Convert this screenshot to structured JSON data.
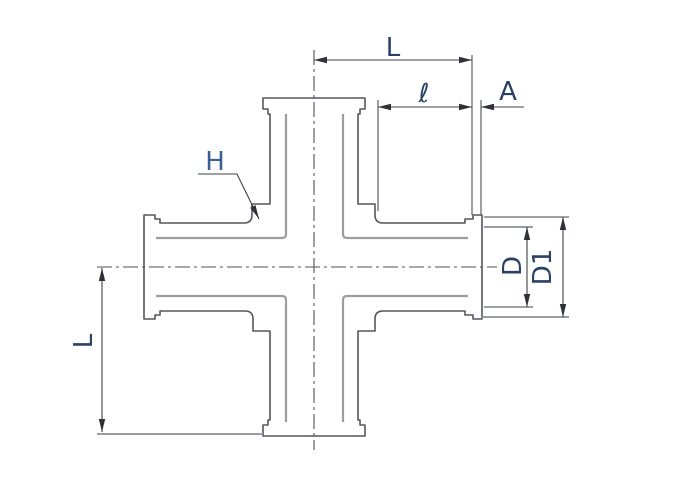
{
  "drawing": {
    "labels": {
      "length_top": "L",
      "port_depth": "ℓ",
      "flange_thickness": "A",
      "wall_ref": "H",
      "tube_diameter": "D",
      "flange_diameter": "D1",
      "length_left": "L"
    },
    "colors": {
      "background": "#ffffff",
      "outline": "#54575d",
      "bore_line": "#9b9da0",
      "centerline": "#4e5156",
      "dimension_line": "#3d4046",
      "arrow": "#2e3136",
      "label_text": "#2b4264",
      "label_h_text": "#3a6093"
    }
  }
}
